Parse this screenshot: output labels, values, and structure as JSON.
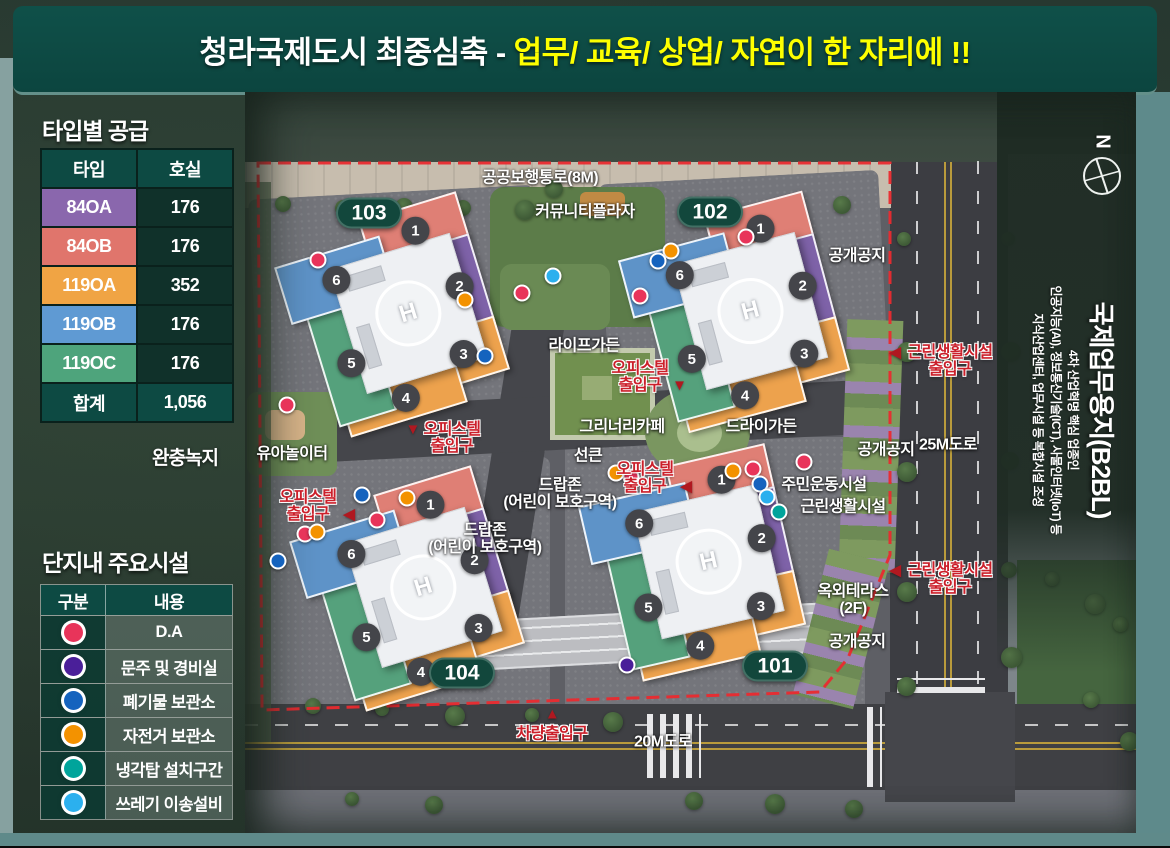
{
  "banner": {
    "title_white": "청라국제도시 최중심축 -",
    "title_yellow": "업무/ 교육/ 상업/ 자연이 한 자리에 !!"
  },
  "supply": {
    "title": "타입별 공급",
    "columns": [
      "타입",
      "호실"
    ],
    "rows": [
      {
        "type": "84OA",
        "rooms": "176",
        "color": "#8a67ad"
      },
      {
        "type": "84OB",
        "rooms": "176",
        "color": "#e0756c"
      },
      {
        "type": "119OA",
        "rooms": "352",
        "color": "#f0a444"
      },
      {
        "type": "119OB",
        "rooms": "176",
        "color": "#5f9ad3"
      },
      {
        "type": "119OC",
        "rooms": "176",
        "color": "#4ea47c"
      }
    ],
    "total_label": "합계",
    "total_value": "1,056"
  },
  "buffer_green_label": "완충녹지",
  "legend": {
    "title": "단지내 주요시설",
    "columns": [
      "구분",
      "내용"
    ],
    "rows": [
      {
        "name": "D.A",
        "key": "red"
      },
      {
        "name": "문주 및 경비실",
        "key": "purple"
      },
      {
        "name": "폐기물 보관소",
        "key": "blue"
      },
      {
        "name": "자전거 보관소",
        "key": "orange"
      },
      {
        "name": "냉각탑 설치구간",
        "key": "teal"
      },
      {
        "name": "쓰레기 이송설비",
        "key": "sky"
      }
    ]
  },
  "palette": {
    "red": "#e8345a",
    "purple": "#4a1f99",
    "blue": "#1563be",
    "orange": "#f39200",
    "teal": "#00a49b",
    "sky": "#2bb0ee"
  },
  "district": {
    "title": "국제업무용지(B2BL)",
    "lines": [
      "4차 산업혁명 핵심 업종인",
      "인공지능(AI), 정보통신기술(ICT), 사물인터넷(IoT) 등",
      "지식산업센터, 업무시설 등 복합시설 조성"
    ],
    "compass": "N"
  },
  "map": {
    "helipad": "H",
    "wing_colors": {
      "1": "#df7f75",
      "2": "#7e62a8",
      "3": "#eda24d",
      "4": "#eda24d",
      "5": "#55a17c",
      "6": "#5e93c8"
    },
    "buildings": [
      {
        "id": "103",
        "x": 390,
        "y": 318,
        "rot": -17
      },
      {
        "id": "102",
        "x": 732,
        "y": 315,
        "rot": -15
      },
      {
        "id": "104",
        "x": 405,
        "y": 592,
        "rot": -17
      },
      {
        "id": "101",
        "x": 690,
        "y": 565,
        "rot": -13
      }
    ],
    "badges": [
      {
        "label": "103",
        "x": 369,
        "y": 213
      },
      {
        "label": "102",
        "x": 710,
        "y": 212
      },
      {
        "label": "104",
        "x": 462,
        "y": 673
      },
      {
        "label": "101",
        "x": 775,
        "y": 666
      }
    ],
    "labels": [
      {
        "lines": [
          "공공보행통로(8M)"
        ],
        "x": 540,
        "y": 178,
        "style": "white"
      },
      {
        "lines": [
          "커뮤니티플라자"
        ],
        "x": 585,
        "y": 212,
        "style": "white"
      },
      {
        "lines": [
          "공개공지"
        ],
        "x": 857,
        "y": 256,
        "style": "white"
      },
      {
        "lines": [
          "라이프가든"
        ],
        "x": 584,
        "y": 346,
        "style": "white"
      },
      {
        "lines": [
          "오피스텔",
          "출입구"
        ],
        "x": 640,
        "y": 377,
        "style": "red",
        "arrow": "▼",
        "arrow_side": "right"
      },
      {
        "lines": [
          "그리너리카페"
        ],
        "x": 622,
        "y": 427,
        "style": "white"
      },
      {
        "lines": [
          "드라이가든"
        ],
        "x": 761,
        "y": 427,
        "style": "white"
      },
      {
        "lines": [
          "선큰"
        ],
        "x": 588,
        "y": 456,
        "style": "white"
      },
      {
        "lines": [
          "오피스텔",
          "출입구"
        ],
        "x": 645,
        "y": 478,
        "style": "red",
        "arrow": "◀",
        "arrow_side": "right"
      },
      {
        "lines": [
          "드랍존",
          "(어린이 보호구역)"
        ],
        "x": 560,
        "y": 494,
        "style": "white"
      },
      {
        "lines": [
          "드랍존",
          "(어린이 보호구역)"
        ],
        "x": 485,
        "y": 539,
        "style": "white"
      },
      {
        "lines": [
          "주민운동시설"
        ],
        "x": 824,
        "y": 485,
        "style": "white"
      },
      {
        "lines": [
          "근린생활시설"
        ],
        "x": 843,
        "y": 507,
        "style": "white"
      },
      {
        "lines": [
          "옥외테라스",
          "(2F)"
        ],
        "x": 853,
        "y": 600,
        "style": "white"
      },
      {
        "lines": [
          "공개공지"
        ],
        "x": 857,
        "y": 642,
        "style": "white"
      },
      {
        "lines": [
          "공개공지"
        ],
        "x": 886,
        "y": 450,
        "style": "white"
      },
      {
        "lines": [
          "25M도로"
        ],
        "x": 948,
        "y": 445,
        "style": "white"
      },
      {
        "lines": [
          "20M도로"
        ],
        "x": 663,
        "y": 742,
        "style": "white"
      },
      {
        "lines": [
          "유아놀이터"
        ],
        "x": 292,
        "y": 454,
        "style": "white"
      },
      {
        "lines": [
          "오피스텔",
          "출입구"
        ],
        "x": 452,
        "y": 438,
        "style": "red",
        "arrow": "▼",
        "arrow_side": "left"
      },
      {
        "lines": [
          "오피스텔",
          "출입구"
        ],
        "x": 308,
        "y": 506,
        "style": "red",
        "arrow": "◀",
        "arrow_side": "right"
      },
      {
        "lines": [
          "근린생활시설",
          "출입구"
        ],
        "x": 950,
        "y": 361,
        "style": "red",
        "arrow": "◀",
        "arrow_side": "left"
      },
      {
        "lines": [
          "근린생활시설",
          "출입구"
        ],
        "x": 950,
        "y": 579,
        "style": "red",
        "arrow": "◀",
        "arrow_side": "left"
      },
      {
        "lines": [
          "차량출입구"
        ],
        "x": 552,
        "y": 734,
        "style": "red",
        "arrow": "▲",
        "arrow_side": "top"
      }
    ],
    "dots": [
      {
        "type": "red",
        "x": 318,
        "y": 260
      },
      {
        "type": "red",
        "x": 522,
        "y": 293
      },
      {
        "type": "red",
        "x": 640,
        "y": 296
      },
      {
        "type": "red",
        "x": 746,
        "y": 237
      },
      {
        "type": "red",
        "x": 287,
        "y": 405
      },
      {
        "type": "red",
        "x": 377,
        "y": 520
      },
      {
        "type": "red",
        "x": 305,
        "y": 534
      },
      {
        "type": "red",
        "x": 631,
        "y": 477
      },
      {
        "type": "red",
        "x": 753,
        "y": 469
      },
      {
        "type": "red",
        "x": 804,
        "y": 462
      },
      {
        "type": "orange",
        "x": 465,
        "y": 300
      },
      {
        "type": "orange",
        "x": 671,
        "y": 251
      },
      {
        "type": "orange",
        "x": 733,
        "y": 471
      },
      {
        "type": "orange",
        "x": 616,
        "y": 473
      },
      {
        "type": "orange",
        "x": 407,
        "y": 498
      },
      {
        "type": "orange",
        "x": 317,
        "y": 532
      },
      {
        "type": "blue",
        "x": 658,
        "y": 261
      },
      {
        "type": "blue",
        "x": 485,
        "y": 356
      },
      {
        "type": "blue",
        "x": 760,
        "y": 484
      },
      {
        "type": "blue",
        "x": 362,
        "y": 495
      },
      {
        "type": "blue",
        "x": 278,
        "y": 561
      },
      {
        "type": "sky",
        "x": 553,
        "y": 276
      },
      {
        "type": "sky",
        "x": 767,
        "y": 497
      },
      {
        "type": "teal",
        "x": 779,
        "y": 512
      },
      {
        "type": "purple",
        "x": 627,
        "y": 665
      }
    ]
  }
}
